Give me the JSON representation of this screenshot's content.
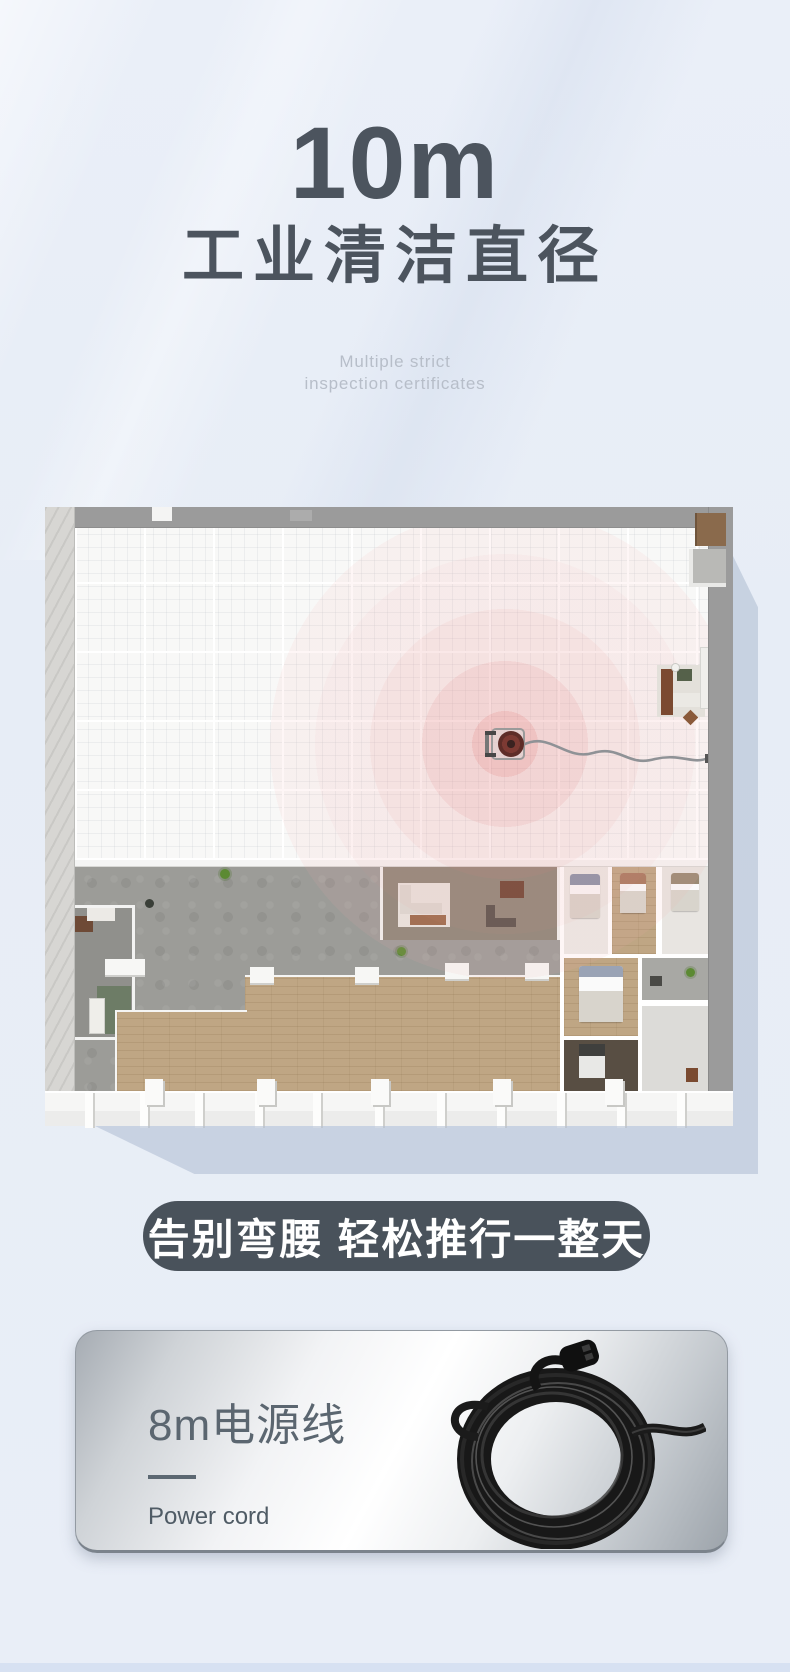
{
  "hero": {
    "headline": "10m",
    "headline_cn": "工业清洁直径",
    "subtitle_line1": "Multiple strict",
    "subtitle_line2": "inspection certificates"
  },
  "banner": {
    "label": "告别弯腰 轻松推行一整天"
  },
  "cord_card": {
    "title": "8m电源线",
    "subtitle": "Power cord"
  },
  "colors": {
    "page_bg": "#e8edf6",
    "heading": "#4c545e",
    "subtitle_gray": "#b7bec9",
    "banner_bg": "#49525b",
    "banner_text": "#ffffff",
    "cleaning_radius_red": "#e06c6c",
    "plan_wall_gray": "#9b9b9b",
    "card_title": "#5b6670",
    "shadow_blue": "#b2c0d4"
  }
}
